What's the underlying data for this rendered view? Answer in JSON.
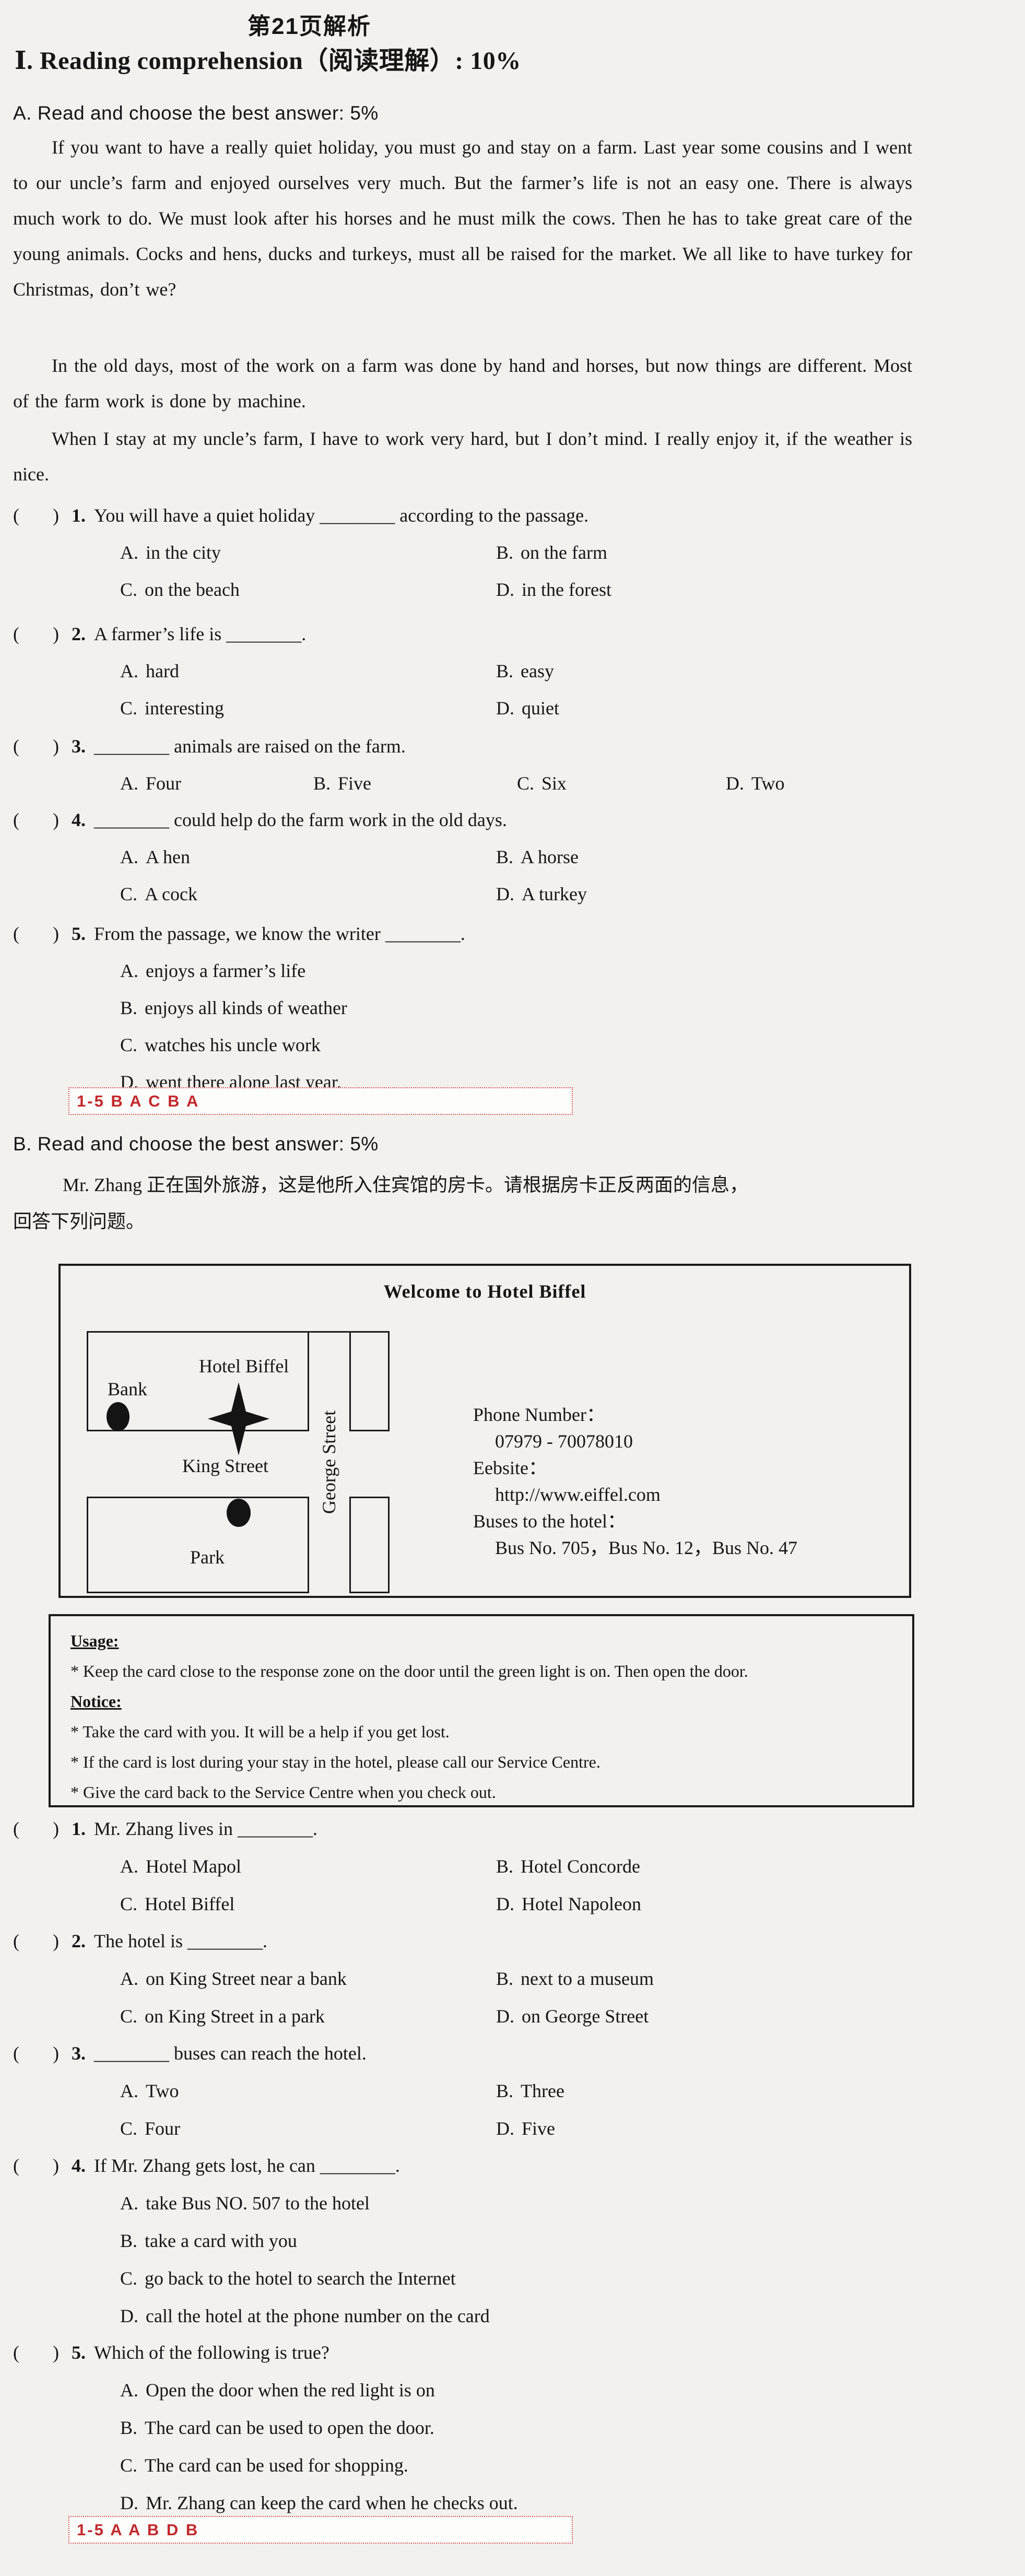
{
  "page_title": "第21页解析",
  "section_heading": "Ⅰ. Reading comprehension（阅读理解）: 10%",
  "format": {
    "bracket_open": "(",
    "bracket_close": ")"
  },
  "part_a": {
    "heading": "A. Read and choose the best answer: 5%",
    "paragraphs": [
      "If you want to have a really quiet holiday, you must go and stay on a farm. Last year some cousins and I went to our uncle’s farm and enjoyed ourselves very much. But the farmer’s life is not an easy one. There is always much work to do. We must look after his horses and he must milk the cows. Then he has to take great care of the young animals. Cocks and hens, ducks and turkeys, must all be raised for the market. We all like to have turkey for Christmas, don’t we?",
      "In the old days, most of the work on a farm was done by hand and horses, but now things are different. Most of the farm work is done by machine.",
      "When I stay at my uncle’s farm, I have to work very hard, but I don’t mind. I really enjoy it, if the weather is nice."
    ],
    "questions": [
      {
        "num": "1.",
        "text": "You will have a quiet holiday ________ according to the passage.",
        "layout": "2col",
        "options": [
          {
            "label": "A.",
            "text": "in the city"
          },
          {
            "label": "B.",
            "text": "on the farm"
          },
          {
            "label": "C.",
            "text": "on the beach"
          },
          {
            "label": "D.",
            "text": "in the forest"
          }
        ]
      },
      {
        "num": "2.",
        "text": "A farmer’s life is ________.",
        "layout": "2col",
        "options": [
          {
            "label": "A.",
            "text": "hard"
          },
          {
            "label": "B.",
            "text": "easy"
          },
          {
            "label": "C.",
            "text": "interesting"
          },
          {
            "label": "D.",
            "text": "quiet"
          }
        ]
      },
      {
        "num": "3.",
        "text": "________ animals are raised on the farm.",
        "layout": "4col",
        "options": [
          {
            "label": "A.",
            "text": "Four"
          },
          {
            "label": "B.",
            "text": "Five"
          },
          {
            "label": "C.",
            "text": "Six"
          },
          {
            "label": "D.",
            "text": "Two"
          }
        ]
      },
      {
        "num": "4.",
        "text": "________ could help do the farm work in the old days.",
        "layout": "2col",
        "options": [
          {
            "label": "A.",
            "text": "A hen"
          },
          {
            "label": "B.",
            "text": "A horse"
          },
          {
            "label": "C.",
            "text": "A cock"
          },
          {
            "label": "D.",
            "text": "A turkey"
          }
        ]
      },
      {
        "num": "5.",
        "text": "From the passage, we know the writer ________.",
        "layout": "1col",
        "options": [
          {
            "label": "A.",
            "text": "enjoys a farmer’s life"
          },
          {
            "label": "B.",
            "text": "enjoys all kinds of weather"
          },
          {
            "label": "C.",
            "text": "watches his uncle work"
          },
          {
            "label": "D.",
            "text": "went there alone last year."
          }
        ]
      }
    ],
    "answer_key": "1-5 B A C B A"
  },
  "part_b": {
    "heading": "B. Read and choose the best answer: 5%",
    "intro_line1": "Mr. Zhang 正在国外旅游，这是他所入住宾馆的房卡。请根据房卡正反两面的信息，",
    "intro_line2": "回答下列问题。",
    "card": {
      "title": "Welcome to Hotel Biffel",
      "map": {
        "hotel": "Hotel Biffel",
        "bank": "Bank",
        "king_street": "King Street",
        "george_street": "George Street",
        "park": "Park"
      },
      "contact": [
        {
          "text": "Phone Number：",
          "indent": false
        },
        {
          "text": "07979 - 70078010",
          "indent": true
        },
        {
          "text": "Eebsite：",
          "indent": false
        },
        {
          "text": "http://www.eiffel.com",
          "indent": true
        },
        {
          "text": "Buses to the hotel：",
          "indent": false
        },
        {
          "text": "Bus No. 705，Bus No. 12，Bus No. 47",
          "indent": true
        }
      ]
    },
    "rules": {
      "usage_title": "Usage:",
      "usage_items": [
        "* Keep the card close to the response zone on the door until the green light is on. Then open the door."
      ],
      "notice_title": "Notice:",
      "notice_items": [
        "* Take the card with you. It will be a help if you get lost.",
        "* If the card is lost during your stay in the hotel, please call our Service Centre.",
        "* Give the card back to the Service Centre when you check out."
      ]
    },
    "questions": [
      {
        "num": "1.",
        "text": "Mr. Zhang lives in ________.",
        "layout": "2col",
        "options": [
          {
            "label": "A.",
            "text": "Hotel Mapol"
          },
          {
            "label": "B.",
            "text": "Hotel Concorde"
          },
          {
            "label": "C.",
            "text": "Hotel Biffel"
          },
          {
            "label": "D.",
            "text": "Hotel Napoleon"
          }
        ]
      },
      {
        "num": "2.",
        "text": "The hotel is ________.",
        "layout": "2col",
        "options": [
          {
            "label": "A.",
            "text": "on King Street near a bank"
          },
          {
            "label": "B.",
            "text": "next to a museum"
          },
          {
            "label": "C.",
            "text": "on King Street in a park"
          },
          {
            "label": "D.",
            "text": "on George Street"
          }
        ]
      },
      {
        "num": "3.",
        "text": "________ buses can reach the hotel.",
        "layout": "2col",
        "options": [
          {
            "label": "A.",
            "text": "Two"
          },
          {
            "label": "B.",
            "text": "Three"
          },
          {
            "label": "C.",
            "text": "Four"
          },
          {
            "label": "D.",
            "text": "Five"
          }
        ]
      },
      {
        "num": "4.",
        "text": "If Mr. Zhang gets lost, he can ________.",
        "layout": "1col",
        "options": [
          {
            "label": "A.",
            "text": "take Bus NO. 507 to the hotel"
          },
          {
            "label": "B.",
            "text": "take a card with you"
          },
          {
            "label": "C.",
            "text": "go back to the hotel to search the Internet"
          },
          {
            "label": "D.",
            "text": "call the hotel at the phone number on the card"
          }
        ]
      },
      {
        "num": "5.",
        "text": "Which of the following is true?",
        "layout": "1col",
        "options": [
          {
            "label": "A.",
            "text": "Open the door when the red light is on"
          },
          {
            "label": "B.",
            "text": "The card can be used to open the door."
          },
          {
            "label": "C.",
            "text": "The card can be used for shopping."
          },
          {
            "label": "D.",
            "text": "Mr. Zhang can keep the card when he checks out."
          }
        ]
      }
    ],
    "answer_key": "1-5 A A B D B"
  },
  "colors": {
    "answer_red": "#c3272b",
    "ink": "#161616"
  }
}
